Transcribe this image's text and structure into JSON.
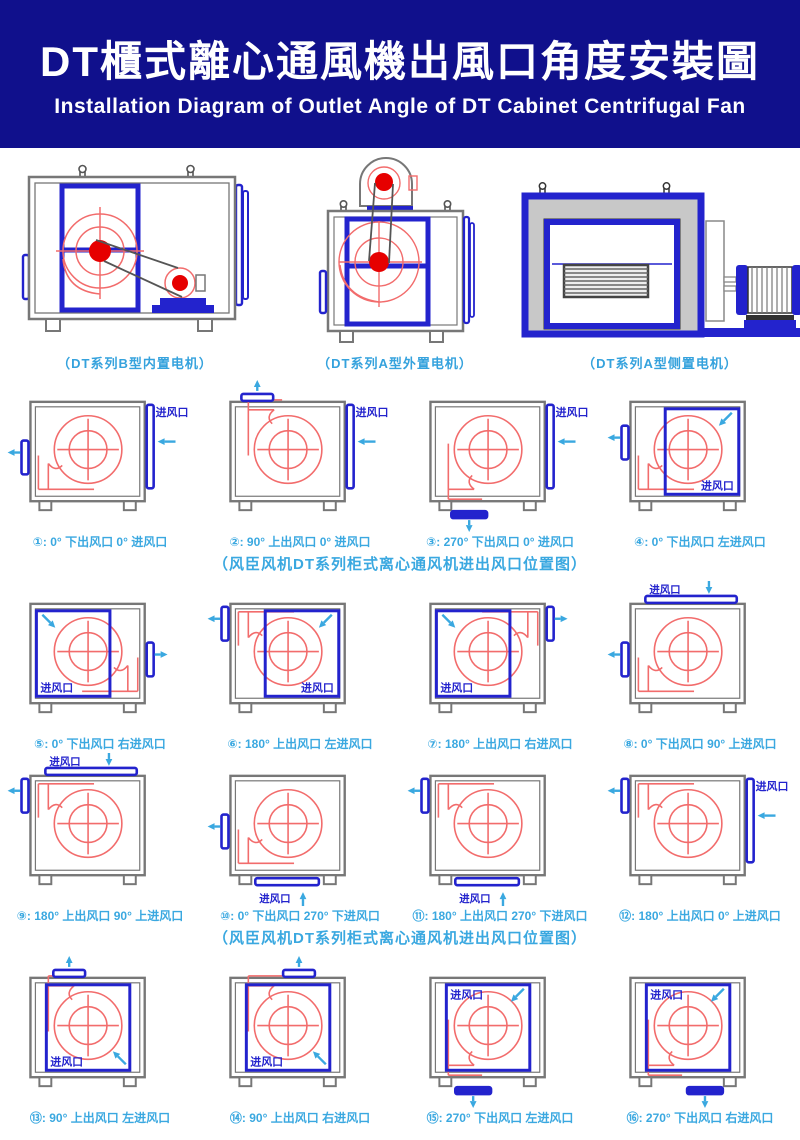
{
  "header": {
    "title_zh": "DT櫃式離心通風機出風口角度安裝圖",
    "subtitle_en": "Installation Diagram of Outlet Angle of DT Cabinet Centrifugal Fan"
  },
  "top_units": [
    {
      "caption": "（DT系列B型内置电机）"
    },
    {
      "caption": "（DT系列A型外置电机）"
    },
    {
      "caption": "（DT系列A型侧置电机）"
    }
  ],
  "section_caption_1": "（风臣风机DT系列柜式离心通风机进出风口位置图）",
  "section_caption_2": "（风臣风机DT系列柜式离心通风机进出风口位置图）",
  "inlet_label": "进风口",
  "colors": {
    "header_bg": "#10108c",
    "royal_blue": "#2323cd",
    "light_blue": "#3aa8e0",
    "fan_red": "#f26c6c",
    "pulley_red": "#e60000",
    "box_gray": "#777777"
  },
  "cells": [
    {
      "label": "①: 0° 下出风口 0° 进风口",
      "scroll": "lb",
      "outlet": {
        "side": "left",
        "pos": "bottom"
      },
      "inlet": {
        "type": "bar-right"
      }
    },
    {
      "label": "②: 90° 上出风口 0° 进风口",
      "scroll": "top",
      "outlet": {
        "side": "top",
        "x": 36
      },
      "inlet": {
        "type": "bar-right"
      }
    },
    {
      "label": "③: 270° 下出风口 0° 进风口",
      "scroll": "bottom",
      "outlet": {
        "side": "bottom",
        "x": 46
      },
      "inlet": {
        "type": "bar-right"
      }
    },
    {
      "label": "④: 0° 下出风口 左进风口",
      "scroll": "lb",
      "outlet": {
        "side": "left",
        "pos": "mid"
      },
      "inlet": {
        "type": "panel",
        "panel": "right",
        "label_corner": "br",
        "arrow": "tr-dl"
      }
    },
    {
      "label": "⑤: 0° 下出风口 右进风口",
      "scroll": "rb",
      "outlet": {
        "side": "right",
        "pos": "bottom"
      },
      "inlet": {
        "type": "panel",
        "panel": "left",
        "label_corner": "bl",
        "arrow": "tl-dr"
      }
    },
    {
      "label": "⑥: 180° 上出风口 左进风口",
      "scroll": "lt",
      "outlet": {
        "side": "left",
        "pos": "top"
      },
      "inlet": {
        "type": "panel",
        "panel": "right",
        "label_corner": "br",
        "arrow": "tr-dl"
      }
    },
    {
      "label": "⑦: 180° 上出风口 右进风口",
      "scroll": "rt",
      "outlet": {
        "side": "right",
        "pos": "top"
      },
      "inlet": {
        "type": "panel",
        "panel": "left",
        "label_corner": "bl",
        "arrow": "tl-dr"
      }
    },
    {
      "label": "⑧: 0° 下出风口 90° 上进风口",
      "scroll": "lb",
      "outlet": {
        "side": "left",
        "pos": "bottom"
      },
      "inlet": {
        "type": "bar-top"
      }
    },
    {
      "label": "⑨: 180° 上出风口 90° 上进风口",
      "scroll": "lt",
      "outlet": {
        "side": "left",
        "pos": "top"
      },
      "inlet": {
        "type": "bar-top"
      }
    },
    {
      "label": "⑩: 0° 下出风口 270° 下进风口",
      "scroll": "lb",
      "outlet": {
        "side": "left",
        "pos": "bottom"
      },
      "inlet": {
        "type": "bar-bottom"
      }
    },
    {
      "label": "⑪: 180° 上出风口 270° 下进风口",
      "scroll": "lt",
      "outlet": {
        "side": "left",
        "pos": "top"
      },
      "inlet": {
        "type": "bar-bottom"
      }
    },
    {
      "label": "⑫: 180° 上出风口 0° 上进风口",
      "scroll": "lt",
      "outlet": {
        "side": "left",
        "pos": "top"
      },
      "inlet": {
        "type": "bar-right"
      }
    },
    {
      "label": "⑬: 90° 上出风口 左进风口",
      "scroll": "top",
      "outlet": {
        "side": "top",
        "x": 48
      },
      "inlet": {
        "type": "panel",
        "panel": "center",
        "label_corner": "bl",
        "arrow": "br-ul"
      }
    },
    {
      "label": "⑭: 90° 上出风口 右进风口",
      "scroll": "top",
      "outlet": {
        "side": "top",
        "x": 78
      },
      "inlet": {
        "type": "panel",
        "panel": "center",
        "label_corner": "bl",
        "arrow": "br-ul"
      }
    },
    {
      "label": "⑮: 270° 下出风口 左进风口",
      "scroll": "bottom",
      "outlet": {
        "side": "bottom",
        "x": 50
      },
      "inlet": {
        "type": "panel",
        "panel": "center",
        "label_corner": "tl",
        "arrow": "tr2-dl"
      }
    },
    {
      "label": "⑯: 270° 下出风口 右进风口",
      "scroll": "bottom",
      "outlet": {
        "side": "bottom",
        "x": 82
      },
      "inlet": {
        "type": "panel",
        "panel": "center",
        "label_corner": "tl",
        "arrow": "tr2-dl"
      }
    }
  ]
}
